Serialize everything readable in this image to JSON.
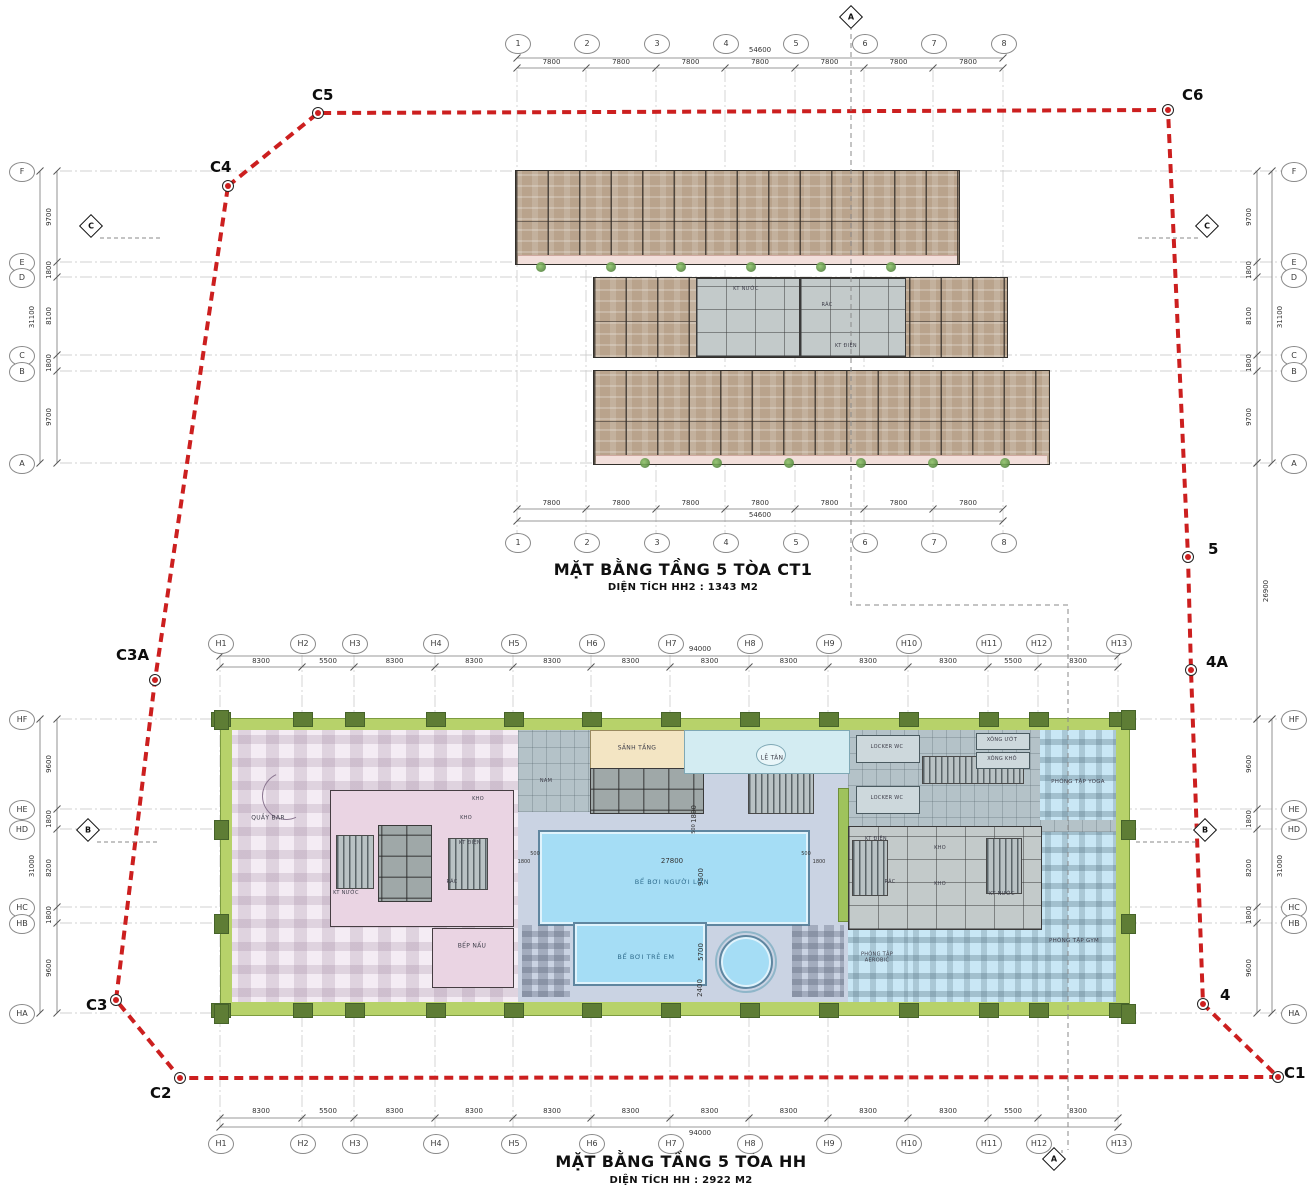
{
  "colors": {
    "boundary_red": "#cc1f1f",
    "grid_grey": "#c4c4c4",
    "dim_grey": "#777777",
    "wood": "#b9a38c",
    "green_band": "#b7d26a",
    "pool_water": "#a5ddf5",
    "deck": "#cad3e3",
    "restaurant_pink": "#f4ecf4",
    "core_pink": "#ead4e3",
    "locker_grey": "#b4c2c8",
    "fitness_blue": "#c9e7f5",
    "lobby_beige": "#f3e5c3",
    "reception_cyan": "#d3ecf2"
  },
  "plans": {
    "ct1": {
      "title": "MẶT BẰNG TẦNG 5 TÒA CT1",
      "subtitle": "DIỆN TÍCH HH2 : 1343 M2",
      "grid": {
        "cols": [
          "1",
          "2",
          "3",
          "4",
          "5",
          "6",
          "7",
          "8"
        ],
        "col_dims": [
          "7800",
          "7800",
          "7800",
          "7800",
          "7800",
          "7800",
          "7800"
        ],
        "col_total": "54600",
        "rows": [
          "F",
          "E",
          "D",
          "C",
          "B",
          "A"
        ],
        "row_dims": [
          "9700",
          "1800",
          "8100",
          "1800",
          "9700"
        ],
        "row_total": "31100"
      },
      "core_labels": [
        "KT NƯỚC",
        "RÁC",
        "KT ĐIỆN"
      ]
    },
    "hh": {
      "title": "MẶT BẰNG TẦNG 5 TÒA HH",
      "subtitle": "DIỆN TÍCH HH : 2922 M2",
      "grid": {
        "cols": [
          "H1",
          "H2",
          "H3",
          "H4",
          "H5",
          "H6",
          "H7",
          "H8",
          "H9",
          "H10",
          "H11",
          "H12",
          "H13"
        ],
        "col_dims": [
          "8300",
          "5500",
          "8300",
          "8300",
          "8300",
          "8300",
          "8300",
          "8300",
          "8300",
          "8300",
          "5500",
          "8300"
        ],
        "col_total": "94000",
        "rows": [
          "HF",
          "HE",
          "HD",
          "HC",
          "HB",
          "HA"
        ],
        "row_dims": [
          "9600",
          "1800",
          "8200",
          "1800",
          "9600"
        ],
        "row_total": "31000"
      },
      "rooms": {
        "quay_bar": "QUẦY BAR",
        "bep_nau": "BẾP NẤU",
        "kho": "KHO",
        "kt_dien": "KT ĐIỆN",
        "kt_nuoc": "KT NƯỚC",
        "rac": "RÁC",
        "sanh_tang": "SẢNH TẦNG",
        "le_tan": "LỄ TÂN",
        "nam": "NAM",
        "adult_pool": "BỂ BƠI NGƯỜI LỚN",
        "kids_pool": "BỂ BƠI TRẺ EM",
        "locker_wc": "LOCKER WC",
        "xong_uot": "XÔNG ƯỚT",
        "xong_kho": "XÔNG KHÔ",
        "yoga": "PHÒNG TẬP YOGA",
        "gym": "PHÒNG TẬP GYM",
        "aerobic": "PHÒNG TẬP AEROBIC"
      },
      "pool_dims": {
        "length": "27800",
        "width": "9500",
        "kids_width": "5700",
        "kids_edge": "2400",
        "offset_500": "500",
        "offset_1800": "1800"
      }
    }
  },
  "boundary_points": [
    "C4",
    "C5",
    "C6",
    "5",
    "4A",
    "4",
    "C1",
    "C2",
    "C3",
    "C3A"
  ],
  "sections": {
    "a": "A",
    "b": "B",
    "c": "C"
  },
  "gap_dim": "26900"
}
